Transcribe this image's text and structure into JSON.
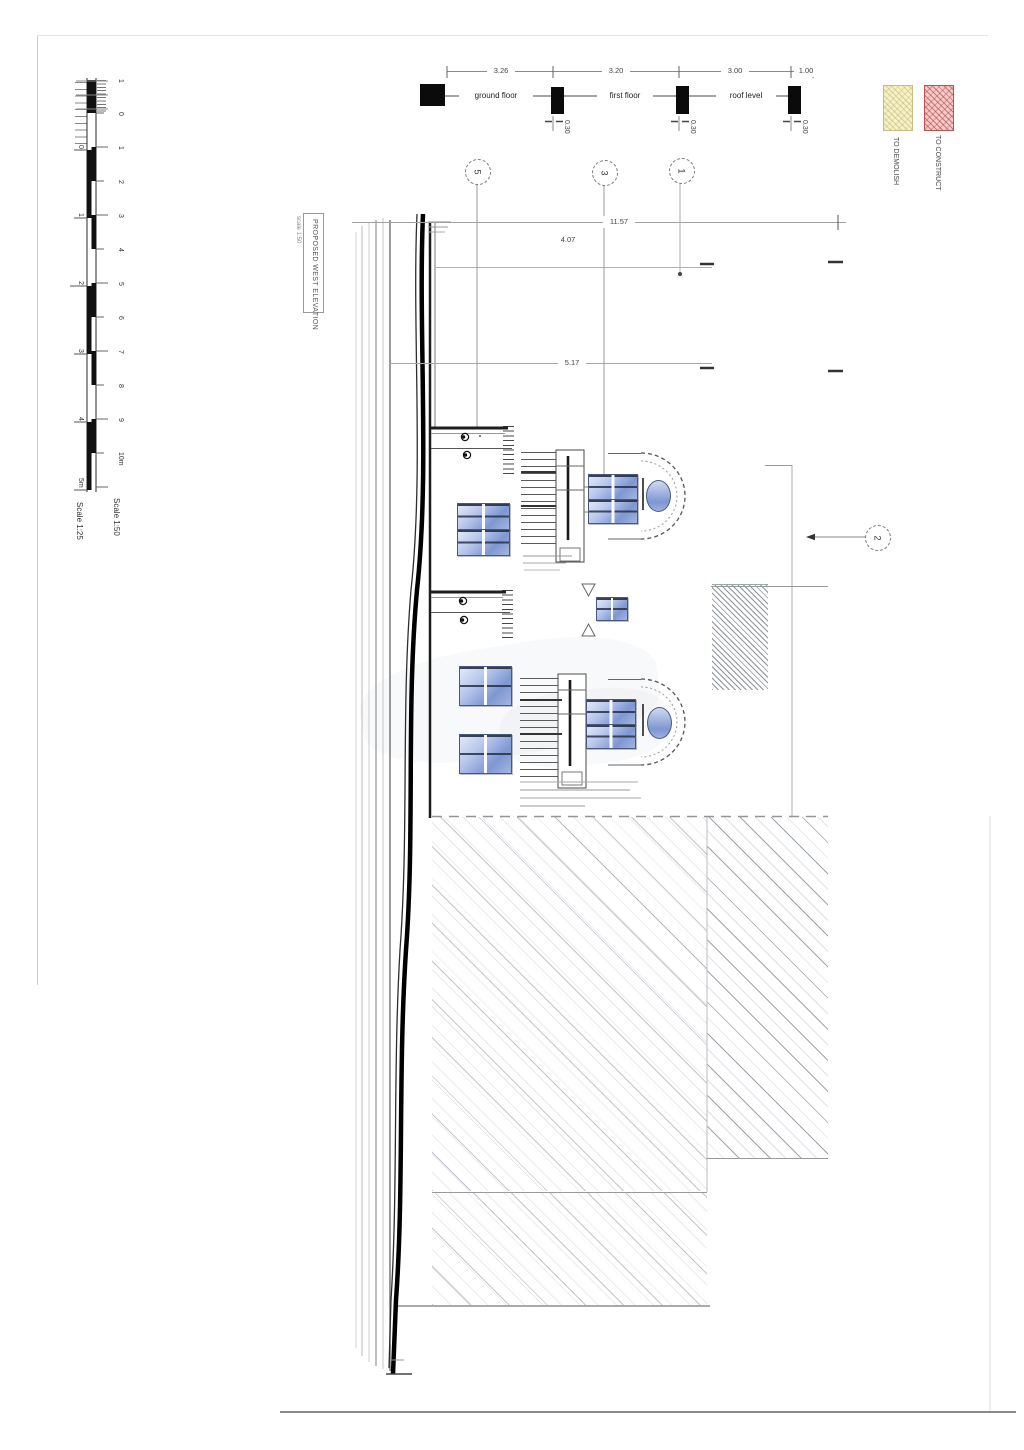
{
  "section_strip": {
    "dim_values": [
      "3.26",
      "3.20",
      "3.00",
      "1.00"
    ],
    "floor_labels": [
      "ground floor",
      "first floor",
      "roof level"
    ],
    "slab_dim": "0.30"
  },
  "plan_dims": {
    "overall": "11.57",
    "upper": "4.07",
    "mid": "5.17"
  },
  "grid_bubbles": {
    "b5": "5",
    "b3": "3",
    "b1": "1",
    "b2": "2"
  },
  "title_block": {
    "title": "PROPOSED WEST ELEVATION",
    "scale_note": "scale 1:50"
  },
  "legend": {
    "demolish_label": "TO DEMOLISH",
    "construct_label": "TO CONSTRUCT",
    "demolish_fill": "#f6f1c6",
    "construct_fill": "#f2cccc",
    "construct_hatch": "#c0504d"
  },
  "scale_bar": {
    "right": {
      "scale_label": "Scale 1:50",
      "marks": [
        "1",
        "0",
        "1",
        "2",
        "3",
        "4",
        "5",
        "6",
        "7",
        "8",
        "9",
        "10m"
      ]
    },
    "left": {
      "scale_label": "Scale 1:25",
      "marks": [
        "0",
        "1",
        "2",
        "3",
        "4",
        "5m"
      ]
    }
  },
  "colors": {
    "window_glass_light": "#d9e1f3",
    "window_glass_dark": "#7e97d2",
    "line_dark": "#222222",
    "hatch_line": "#9aa2b0"
  }
}
